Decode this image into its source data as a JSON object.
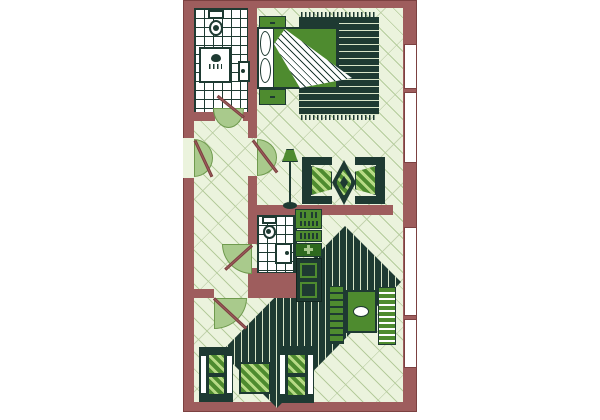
{
  "meta": {
    "title": "apartment-floor-plan",
    "type": "architectural floor plan, top-down view"
  },
  "palette": {
    "wall": "#9e5d5d",
    "wallDark": "#7c4141",
    "floor": "#ebf3dd",
    "floorLine": "#b5cc9c",
    "dark": "#1e3a32",
    "green": "#4e8b2f",
    "greenDark": "#2e691e",
    "arc": "#a9ca8c",
    "arcBorder": "#6f9a4e",
    "stripe": "#d9e5c8",
    "cushionStripe": "#b7da85",
    "white": "#ffffff"
  },
  "canvas": {
    "w": 600,
    "h": 420,
    "bg": "#ffffff"
  },
  "rooms": [
    {
      "name": "bathroom-1",
      "features": [
        "toilet",
        "shower",
        "sink",
        "tiled floor"
      ]
    },
    {
      "name": "bedroom",
      "features": [
        "double bed",
        "two nightstands",
        "fringed rug",
        "window"
      ]
    },
    {
      "name": "hallway",
      "features": [
        "entry door",
        "four interior doors"
      ]
    },
    {
      "name": "sitting-area",
      "features": [
        "floor lamp",
        "two armchairs",
        "diamond rug",
        "window"
      ]
    },
    {
      "name": "bathroom-2",
      "features": [
        "toilet",
        "sink",
        "tiled floor"
      ]
    },
    {
      "name": "kitchen-nook",
      "features": [
        "stove",
        "sink counter",
        "cabinet",
        "fridge"
      ]
    },
    {
      "name": "living-dining-room",
      "features": [
        "striped diamond rug",
        "dining table",
        "two chairs",
        "two sofas",
        "ottoman",
        "windows"
      ]
    }
  ],
  "shapes": [
    {
      "n": "outer-wall",
      "x": 183,
      "y": 0,
      "w": 234,
      "h": 412,
      "css": "background:var(--wall);border:1px solid var(--wallDark)"
    },
    {
      "n": "floor-interior",
      "x": 194,
      "y": 8,
      "w": 209,
      "h": 394,
      "cls": "floor"
    },
    {
      "n": "room-bedroom",
      "x": 257,
      "y": 8,
      "w": 146,
      "h": 130,
      "cls": "room"
    },
    {
      "n": "room-hallway",
      "x": 194,
      "y": 118,
      "w": 54,
      "h": 171,
      "cls": "room"
    },
    {
      "n": "room-sitting-area",
      "x": 257,
      "y": 138,
      "w": 146,
      "h": 67,
      "cls": "room"
    },
    {
      "n": "room-living-dining",
      "x": 194,
      "y": 215,
      "w": 209,
      "h": 187,
      "cls": "room"
    },
    {
      "n": "living-room-rug",
      "x": 200,
      "y": 220,
      "w": 205,
      "h": 192,
      "cls": "rugV",
      "css": "clip-path:polygon(145px 6px,201px 62px,77px 188px,21px 132px)"
    },
    {
      "n": "bathroom-1-floor",
      "x": 194,
      "y": 8,
      "w": 54,
      "h": 105,
      "cls": "tiles"
    },
    {
      "n": "bathroom-2-floor",
      "x": 257,
      "y": 215,
      "w": 37,
      "h": 58,
      "cls": "tiles"
    },
    {
      "n": "bedroom-rug-fringe-top",
      "x": 301,
      "y": 12,
      "w": 76,
      "h": 5,
      "cls": "fringe"
    },
    {
      "n": "bedroom-rug",
      "x": 299,
      "y": 17,
      "w": 80,
      "h": 98,
      "cls": "rugH"
    },
    {
      "n": "bedroom-rug-solid-panel",
      "x": 299,
      "y": 17,
      "w": 40,
      "h": 71,
      "cls": "dark"
    },
    {
      "n": "bedroom-rug-fringe-bottom",
      "x": 301,
      "y": 115,
      "w": 76,
      "h": 5,
      "cls": "fringe"
    },
    {
      "n": "wall-bathroom1-right",
      "x": 248,
      "y": 8,
      "w": 9,
      "h": 130,
      "cls": "wall"
    },
    {
      "n": "wall-hall-room-divider",
      "x": 248,
      "y": 176,
      "w": 9,
      "h": 68,
      "cls": "wall"
    },
    {
      "n": "wall-hall-bath2-divider",
      "x": 248,
      "y": 268,
      "w": 9,
      "h": 30,
      "cls": "wall"
    },
    {
      "n": "wall-bathroom1-bottom",
      "x": 194,
      "y": 112,
      "w": 21,
      "h": 9,
      "cls": "wall"
    },
    {
      "n": "wall-bathroom1-bottom-stub",
      "x": 243,
      "y": 112,
      "w": 5,
      "h": 9,
      "cls": "wall"
    },
    {
      "n": "wall-mid-horizontal",
      "x": 248,
      "y": 205,
      "w": 145,
      "h": 10,
      "cls": "wall"
    },
    {
      "n": "wall-bathroom2-right",
      "x": 294,
      "y": 215,
      "w": 3,
      "h": 58,
      "cls": "dark"
    },
    {
      "n": "wall-bathroom2-bottom",
      "x": 248,
      "y": 273,
      "w": 49,
      "h": 25,
      "cls": "wall"
    },
    {
      "n": "wall-hall-bottom",
      "x": 194,
      "y": 289,
      "w": 20,
      "h": 9,
      "cls": "wall"
    },
    {
      "n": "entry-door-opening",
      "x": 183,
      "y": 138,
      "w": 11,
      "h": 40,
      "css": "background:var(--floor)"
    },
    {
      "n": "window-bedroom",
      "x": 404,
      "y": 44,
      "w": 13,
      "h": 45,
      "cls": "window"
    },
    {
      "n": "window-sitting",
      "x": 404,
      "y": 92,
      "w": 13,
      "h": 71,
      "cls": "window"
    },
    {
      "n": "window-dining",
      "x": 404,
      "y": 227,
      "w": 13,
      "h": 89,
      "cls": "window"
    },
    {
      "n": "window-living",
      "x": 404,
      "y": 319,
      "w": 13,
      "h": 49,
      "cls": "window"
    },
    {
      "n": "toilet-1-tank",
      "x": 208,
      "y": 10,
      "w": 16,
      "h": 9,
      "cls": "white-fixture"
    },
    {
      "n": "toilet-1-bowl",
      "x": 209,
      "y": 20,
      "w": 14,
      "h": 16,
      "cls": "white-fixture",
      "css": "border-radius:50%"
    },
    {
      "n": "toilet-1-seat-dot",
      "x": 213,
      "y": 25,
      "w": 6,
      "h": 6,
      "cls": "dark",
      "css": "border-radius:50%"
    },
    {
      "n": "shower-tray",
      "x": 199,
      "y": 47,
      "w": 32,
      "h": 36,
      "cls": "white-fixture"
    },
    {
      "n": "shower-head-icon",
      "x": 211,
      "y": 54,
      "w": 10,
      "h": 8,
      "cls": "dark",
      "css": "border-radius:50% 50% 50% 50%/60% 60% 40% 40%"
    },
    {
      "n": "shower-spray-icon",
      "x": 209,
      "y": 64,
      "w": 13,
      "h": 5,
      "cls": "drops"
    },
    {
      "n": "sink-1",
      "x": 238,
      "y": 61,
      "w": 12,
      "h": 21,
      "cls": "white-fixture"
    },
    {
      "n": "sink-1-drain-dot",
      "x": 241,
      "y": 69,
      "w": 4,
      "h": 4,
      "cls": "dark",
      "css": "border-radius:50%"
    },
    {
      "n": "nightstand-top",
      "x": 259,
      "y": 16,
      "w": 27,
      "h": 14,
      "cls": "green"
    },
    {
      "n": "nightstand-top-handle",
      "x": 270,
      "y": 22,
      "w": 5,
      "h": 2,
      "cls": "dark"
    },
    {
      "n": "bed-mattress",
      "x": 257,
      "y": 27,
      "w": 81,
      "h": 62,
      "cls": "white-fixture"
    },
    {
      "n": "bed-pillow-1",
      "x": 260,
      "y": 31,
      "w": 11,
      "h": 25,
      "css": "background:#fff;border:1.5px solid var(--dark);border-radius:45% 55% 55% 45%/50%"
    },
    {
      "n": "bed-pillow-2",
      "x": 260,
      "y": 58,
      "w": 11,
      "h": 25,
      "css": "background:#fff;border:1.5px solid var(--dark);border-radius:45% 55% 55% 45%/50%"
    },
    {
      "n": "bed-blanket",
      "x": 273,
      "y": 28,
      "w": 64,
      "h": 60,
      "cls": "green"
    },
    {
      "n": "bed-folded-sheet",
      "x": 273,
      "y": 28,
      "w": 87,
      "h": 61,
      "cls": "fold",
      "css": "clip-path:polygon(12px 1px,79px 50px,27px 60px,1px 16px)"
    },
    {
      "n": "nightstand-bottom",
      "x": 259,
      "y": 89,
      "w": 27,
      "h": 16,
      "cls": "green"
    },
    {
      "n": "nightstand-bottom-handle",
      "x": 270,
      "y": 96,
      "w": 5,
      "h": 2,
      "cls": "dark"
    },
    {
      "n": "floor-lamp-shade",
      "x": 282,
      "y": 149,
      "w": 16,
      "h": 13,
      "css": "background:var(--green);border:1px solid var(--dark);clip-path:polygon(28% 0,72% 0,100% 100%,0 100%)"
    },
    {
      "n": "floor-lamp-pole",
      "x": 289,
      "y": 162,
      "w": 2,
      "h": 42,
      "cls": "dark"
    },
    {
      "n": "floor-lamp-base",
      "x": 283,
      "y": 202,
      "w": 14,
      "h": 7,
      "cls": "dark",
      "css": "border-radius:50%"
    },
    {
      "n": "armchair-left-back",
      "x": 302,
      "y": 157,
      "w": 9,
      "h": 47,
      "cls": "dark"
    },
    {
      "n": "armchair-left-arm-top",
      "x": 302,
      "y": 157,
      "w": 30,
      "h": 8,
      "cls": "dark"
    },
    {
      "n": "armchair-left-arm-bottom",
      "x": 302,
      "y": 196,
      "w": 30,
      "h": 8,
      "cls": "dark"
    },
    {
      "n": "armchair-left-cushion",
      "x": 311,
      "y": 166,
      "w": 21,
      "h": 29,
      "cls": "cushion",
      "css": "clip-path:polygon(0 0,100% 20%,100% 80%,0 100%)"
    },
    {
      "n": "sitting-diamond-rug-outer",
      "x": 332,
      "y": 160,
      "w": 24,
      "h": 45,
      "cls": "dark",
      "css": "clip-path:polygon(50% 0,100% 50%,50% 100%,0 50%)"
    },
    {
      "n": "sitting-diamond-rug-mid",
      "x": 336,
      "y": 169,
      "w": 16,
      "h": 27,
      "cls": "cushion",
      "css": "clip-path:polygon(50% 0,100% 50%,50% 100%,0 50%)"
    },
    {
      "n": "sitting-diamond-rug-center",
      "x": 340,
      "y": 176,
      "w": 8,
      "h": 13,
      "cls": "dark",
      "css": "clip-path:polygon(50% 0,100% 50%,50% 100%,0 50%)"
    },
    {
      "n": "armchair-right-back",
      "x": 376,
      "y": 157,
      "w": 9,
      "h": 47,
      "cls": "dark"
    },
    {
      "n": "armchair-right-arm-top",
      "x": 355,
      "y": 157,
      "w": 30,
      "h": 8,
      "cls": "dark"
    },
    {
      "n": "armchair-right-arm-bottom",
      "x": 355,
      "y": 196,
      "w": 30,
      "h": 8,
      "cls": "dark"
    },
    {
      "n": "armchair-right-cushion",
      "x": 355,
      "y": 166,
      "w": 21,
      "h": 29,
      "cls": "cushion",
      "css": "clip-path:polygon(0 20%,100% 0,100% 100%,0 80%)"
    },
    {
      "n": "stove",
      "x": 295,
      "y": 209,
      "w": 27,
      "h": 20,
      "cls": "green"
    },
    {
      "n": "stove-burner-1",
      "x": 298,
      "y": 212,
      "w": 9,
      "h": 6,
      "cls": "dotsSlot"
    },
    {
      "n": "stove-burner-2",
      "x": 309,
      "y": 212,
      "w": 9,
      "h": 6,
      "cls": "dotsSlot"
    },
    {
      "n": "stove-oven-slot",
      "x": 298,
      "y": 221,
      "w": 20,
      "h": 5,
      "cls": "dotsSlot"
    },
    {
      "n": "kitchen-counter",
      "x": 295,
      "y": 230,
      "w": 27,
      "h": 12,
      "cls": "green"
    },
    {
      "n": "kitchen-counter-slot",
      "x": 298,
      "y": 233,
      "w": 20,
      "h": 6,
      "cls": "dotsSlot"
    },
    {
      "n": "kitchen-unit",
      "x": 295,
      "y": 243,
      "w": 27,
      "h": 14,
      "css": "background:var(--greenDark);border:1px solid var(--dark)"
    },
    {
      "n": "kitchen-unit-plus-h",
      "x": 304,
      "y": 248,
      "w": 9,
      "h": 3,
      "css": "background:var(--arc)"
    },
    {
      "n": "kitchen-unit-plus-v",
      "x": 307,
      "y": 245,
      "w": 3,
      "h": 9,
      "css": "background:var(--arc)"
    },
    {
      "n": "fridge",
      "x": 296,
      "y": 258,
      "w": 26,
      "h": 44,
      "css": "background:var(--dark);border:1px solid #12261f"
    },
    {
      "n": "fridge-door-panel-1",
      "x": 300,
      "y": 263,
      "w": 17,
      "h": 15,
      "css": "border:2px solid var(--green)"
    },
    {
      "n": "fridge-door-panel-2",
      "x": 300,
      "y": 282,
      "w": 17,
      "h": 16,
      "css": "border:2px solid var(--green)"
    },
    {
      "n": "toilet-2-tank",
      "x": 262,
      "y": 216,
      "w": 15,
      "h": 8,
      "cls": "white-fixture"
    },
    {
      "n": "toilet-2-bowl",
      "x": 263,
      "y": 225,
      "w": 13,
      "h": 14,
      "cls": "white-fixture",
      "css": "border-radius:50%"
    },
    {
      "n": "toilet-2-seat-dot",
      "x": 266,
      "y": 229,
      "w": 5,
      "h": 5,
      "cls": "dark",
      "css": "border-radius:50%"
    },
    {
      "n": "sink-2",
      "x": 275,
      "y": 243,
      "w": 17,
      "h": 21,
      "cls": "white-fixture"
    },
    {
      "n": "sink-2-drain-dot",
      "x": 285,
      "y": 251,
      "w": 4,
      "h": 4,
      "cls": "dark",
      "css": "border-radius:50%"
    },
    {
      "n": "dining-table",
      "x": 346,
      "y": 290,
      "w": 31,
      "h": 43,
      "cls": "green",
      "css": "border-width:2px"
    },
    {
      "n": "dining-plate",
      "x": 353,
      "y": 306,
      "w": 16,
      "h": 11,
      "css": "background:#fff;border:1px solid var(--dark);border-radius:50%"
    },
    {
      "n": "dining-chair-left",
      "x": 329,
      "y": 286,
      "w": 15,
      "h": 58,
      "cls": "slats"
    },
    {
      "n": "dining-chair-right",
      "x": 378,
      "y": 287,
      "w": 18,
      "h": 58,
      "cls": "slatsLight"
    },
    {
      "n": "sofa-left-base",
      "x": 199,
      "y": 347,
      "w": 34,
      "h": 55,
      "cls": "dark"
    },
    {
      "n": "sofa-left-armrest-outer",
      "x": 200,
      "y": 355,
      "w": 7,
      "h": 39,
      "css": "background:#fff;border:1px solid var(--dark)"
    },
    {
      "n": "sofa-left-armrest-inner",
      "x": 226,
      "y": 355,
      "w": 7,
      "h": 39,
      "css": "background:#fff;border:1px solid var(--dark)"
    },
    {
      "n": "sofa-left-cushion-1",
      "x": 208,
      "y": 354,
      "w": 17,
      "h": 20,
      "cls": "cushion"
    },
    {
      "n": "sofa-left-cushion-2",
      "x": 208,
      "y": 376,
      "w": 17,
      "h": 19,
      "cls": "cushion"
    },
    {
      "n": "ottoman",
      "x": 239,
      "y": 362,
      "w": 32,
      "h": 32,
      "cls": "cushion",
      "css": "border-width:2px"
    },
    {
      "n": "sofa-right-base",
      "x": 278,
      "y": 346,
      "w": 36,
      "h": 57,
      "cls": "dark"
    },
    {
      "n": "sofa-right-armrest-inner",
      "x": 279,
      "y": 354,
      "w": 7,
      "h": 41,
      "css": "background:#fff;border:1px solid var(--dark)"
    },
    {
      "n": "sofa-right-armrest-outer",
      "x": 307,
      "y": 354,
      "w": 7,
      "h": 41,
      "css": "background:#fff;border:1px solid var(--dark)"
    },
    {
      "n": "sofa-right-cushion-1",
      "x": 287,
      "y": 354,
      "w": 19,
      "h": 20,
      "cls": "cushion"
    },
    {
      "n": "sofa-right-cushion-2",
      "x": 287,
      "y": 376,
      "w": 19,
      "h": 20,
      "cls": "cushion"
    },
    {
      "n": "entry-door-swing-arc",
      "x": 194,
      "y": 139,
      "w": 19,
      "h": 38,
      "cls": "arcD",
      "css": "border-radius:0 100% 100% 0/0 50% 50% 0"
    },
    {
      "n": "entry-door-leaf",
      "x": 195,
      "y": 139,
      "w": 40,
      "h": 3,
      "cls": "leaf",
      "css": "transform:rotate(65deg)"
    },
    {
      "n": "bathroom1-door-swing-arc",
      "x": 213,
      "y": 108,
      "w": 31,
      "h": 20,
      "cls": "arcD",
      "css": "border-radius:0 0 50% 50%/0 0 100% 100%"
    },
    {
      "n": "bathroom1-door-leaf",
      "x": 244,
      "y": 116,
      "w": 34,
      "h": 3,
      "cls": "leaf",
      "css": "transform:rotate(-141deg)"
    },
    {
      "n": "hall-room-door-swing-arc",
      "x": 257,
      "y": 139,
      "w": 20,
      "h": 37,
      "cls": "arcD",
      "css": "border-radius:0 100% 100% 0/0 50% 50% 0"
    },
    {
      "n": "hall-room-door-leaf",
      "x": 253,
      "y": 139,
      "w": 40,
      "h": 3,
      "cls": "leaf",
      "css": "transform:rotate(53deg)"
    },
    {
      "n": "bathroom2-door-swing-arc",
      "x": 222,
      "y": 244,
      "w": 30,
      "h": 30,
      "cls": "arcD",
      "css": "border-radius:0 0 0 100%"
    },
    {
      "n": "bathroom2-door-leaf",
      "x": 252,
      "y": 244,
      "w": 36,
      "h": 3,
      "cls": "leaf",
      "css": "transform:rotate(138deg)"
    },
    {
      "n": "hall-living-door-swing-arc",
      "x": 214,
      "y": 298,
      "w": 33,
      "h": 31,
      "cls": "arcD",
      "css": "border-radius:0 0 100% 0"
    },
    {
      "n": "hall-living-door-leaf",
      "x": 214,
      "y": 297,
      "w": 44,
      "h": 3,
      "cls": "leaf",
      "css": "transform:rotate(43deg)"
    }
  ]
}
